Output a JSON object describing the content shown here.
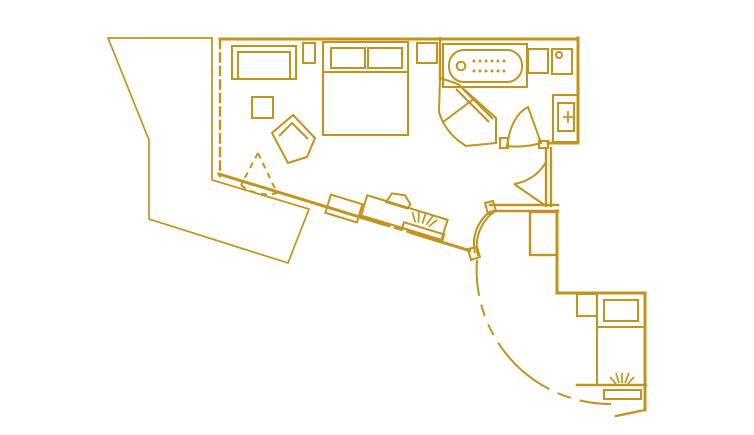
{
  "document": {
    "kind": "floor-plan"
  },
  "colors": {
    "line": "#C2931D",
    "background": "#FFFFFF"
  },
  "elements": {
    "balcony": [
      "deck-hatching",
      "sliding-door-dashed",
      "balcony-door-swing-dashed"
    ],
    "living_area": [
      "sofa",
      "side-table",
      "lounge-chair"
    ],
    "sleeping_area": [
      "double-bed",
      "pillow",
      "pillow",
      "nightstand-left",
      "nightstand-right"
    ],
    "work_area": [
      "console",
      "desk",
      "desk-chair",
      "tv-panel",
      "light-rays"
    ],
    "bathroom": [
      "bathtub-with-jets",
      "tub-faucet",
      "sink",
      "toilet",
      "tall-cabinet-with-cross",
      "corner-shower",
      "bathroom-door"
    ],
    "hallway": [
      "wc-door",
      "wall-column",
      "interior-door",
      "large-door-swing-dashed"
    ],
    "entry_area": [
      "single-bed",
      "pillow",
      "nightstand",
      "entry-mat",
      "light-rays"
    ]
  }
}
